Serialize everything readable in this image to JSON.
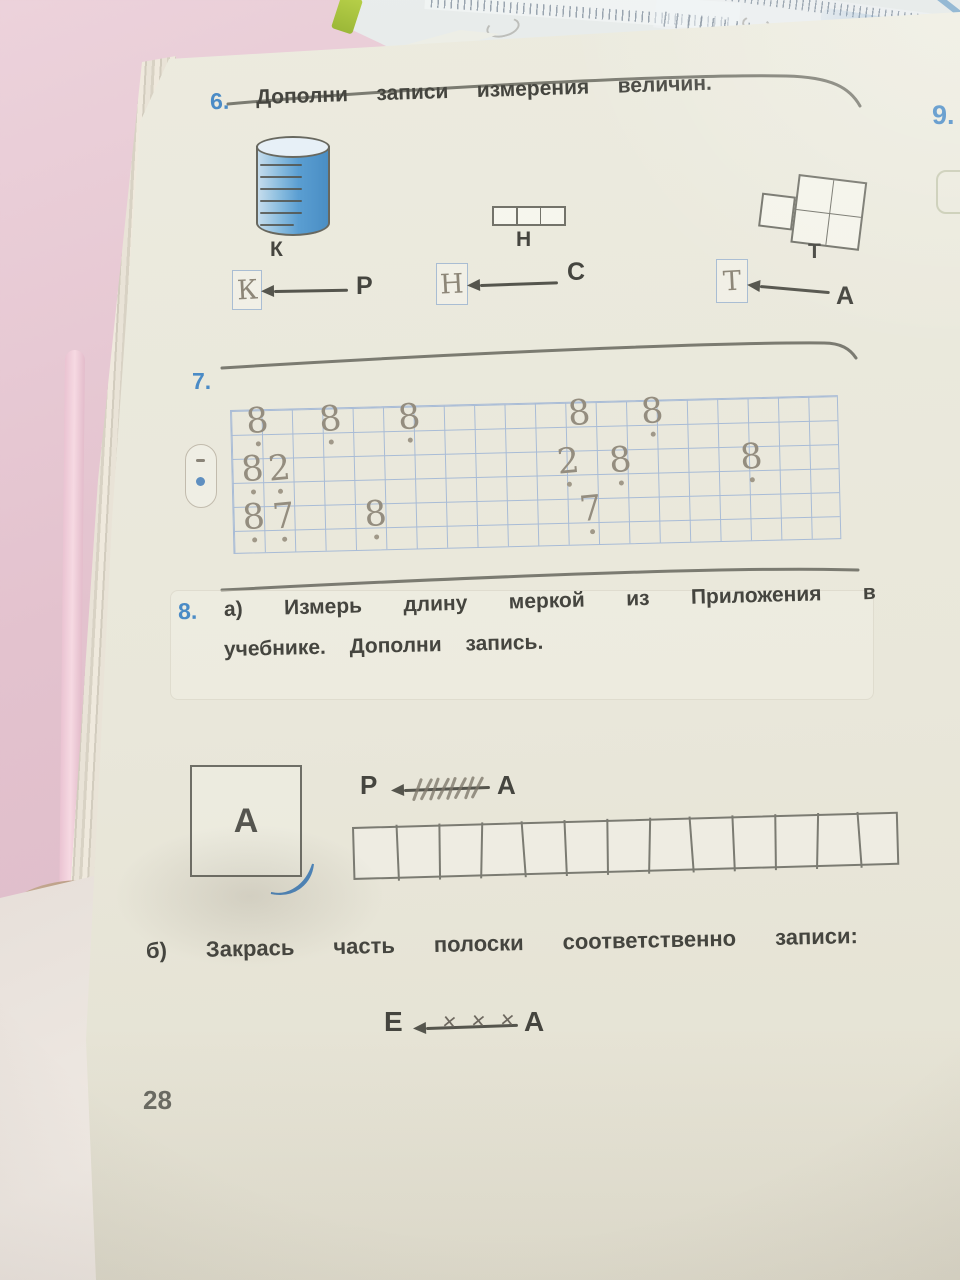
{
  "photo": {
    "surface_color": "#e3c2ce",
    "page_color": "#e9e7db",
    "accent_blue": "#4a8bc6",
    "pencil_gray": "#8d8678",
    "print_color": "#45453f"
  },
  "behind_page": {
    "ruler_numbers": [
      "68",
      "69"
    ]
  },
  "adjacent_page": {
    "exercise_number": "9."
  },
  "exercise6": {
    "number": "6.",
    "title": "Дополни записи измерения величин.",
    "figures": [
      {
        "type": "cylinder-measure",
        "label": "К"
      },
      {
        "type": "strip-measure",
        "label": "Н"
      },
      {
        "type": "tile-measure",
        "label": "Т"
      }
    ],
    "matches": [
      {
        "box": "К",
        "source": "Р"
      },
      {
        "box": "Н",
        "source": "С"
      },
      {
        "box": "Т",
        "source": "А"
      }
    ]
  },
  "exercise7": {
    "number": "7.",
    "grid": {
      "cols": 20,
      "rows": 6
    },
    "handwriting": [
      {
        "r": 0,
        "c": 0.3,
        "ch": "8"
      },
      {
        "r": 0,
        "c": 2.7,
        "ch": "8"
      },
      {
        "r": 0,
        "c": 5.3,
        "ch": "8"
      },
      {
        "r": 0,
        "c": 10.9,
        "ch": "8"
      },
      {
        "r": 0,
        "c": 13.3,
        "ch": "8"
      },
      {
        "r": 2,
        "c": 0.1,
        "ch": "8"
      },
      {
        "r": 2,
        "c": 1.0,
        "ch": "2"
      },
      {
        "r": 2,
        "c": 10.5,
        "ch": "2"
      },
      {
        "r": 2,
        "c": 12.2,
        "ch": "8"
      },
      {
        "r": 2,
        "c": 16.5,
        "ch": "8"
      },
      {
        "r": 4,
        "c": 0.1,
        "ch": "8"
      },
      {
        "r": 4,
        "c": 1.1,
        "ch": "7"
      },
      {
        "r": 4,
        "c": 4.1,
        "ch": "8"
      },
      {
        "r": 4,
        "c": 11.2,
        "ch": "7"
      }
    ],
    "dots": [
      {
        "r": 1,
        "c": 0.4
      },
      {
        "r": 1,
        "c": 2.8
      },
      {
        "r": 1,
        "c": 5.4
      },
      {
        "r": 1,
        "c": 13.4
      },
      {
        "r": 3,
        "c": 0.2
      },
      {
        "r": 3,
        "c": 1.1
      },
      {
        "r": 3,
        "c": 10.6
      },
      {
        "r": 3,
        "c": 12.3
      },
      {
        "r": 3,
        "c": 16.6
      },
      {
        "r": 5,
        "c": 0.2
      },
      {
        "r": 5,
        "c": 1.2
      },
      {
        "r": 5,
        "c": 4.2
      },
      {
        "r": 5,
        "c": 11.3
      }
    ]
  },
  "exercise8": {
    "number": "8.",
    "part_a_line1": "а) Измерь длину меркой из Приложения в",
    "part_a_line2": "учебнике. Дополни запись.",
    "square_label": "А",
    "measure_arrow": {
      "left": "Р",
      "right": "А",
      "tally_count": 8
    },
    "strip_cells": 13,
    "part_b_line": "б) Закрась часть полоски соответственно записи:",
    "shade_arrow": {
      "left": "Е",
      "right": "А",
      "cross_count": 3
    }
  },
  "page_number": "28"
}
